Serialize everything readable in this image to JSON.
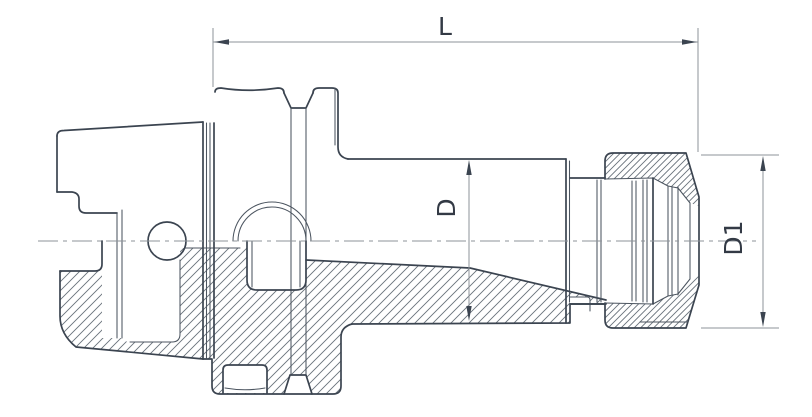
{
  "drawing": {
    "kind": "technical-drawing",
    "subject": "collet chuck tool holder cross-section",
    "labels": {
      "length": "L",
      "body_diameter": "D",
      "nut_diameter": "D1"
    },
    "colors": {
      "background": "#ffffff",
      "outline": "#3b4450",
      "thin_line": "#4c5560",
      "dimension": "#8d9399",
      "text": "#333a45",
      "hatch": "#68717b"
    }
  }
}
